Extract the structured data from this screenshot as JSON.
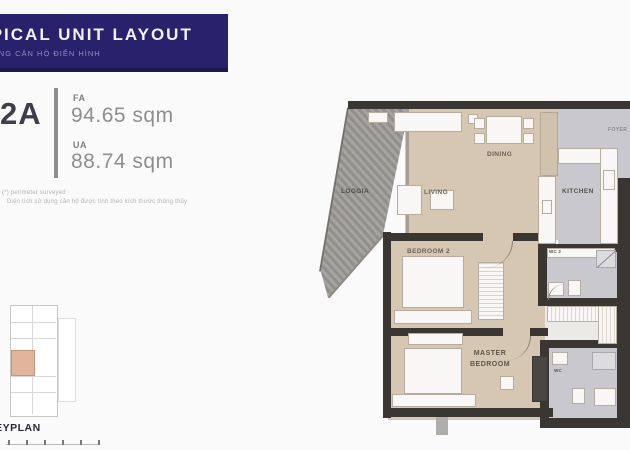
{
  "header": {
    "title": "TYPICAL UNIT LAYOUT",
    "subtitle": "MẶT BẰNG CĂN HỘ ĐIỂN HÌNH"
  },
  "unit": {
    "code": "2A",
    "fa_label": "FA",
    "fa_value": "94.65 sqm",
    "ua_label": "UA",
    "ua_value": "88.74 sqm"
  },
  "notes": {
    "line1": "(*) perimeter surveyed",
    "line2": "Diện tích sử dụng căn hộ được tính theo kích thước thông thủy"
  },
  "keyplan": {
    "label": "KEYPLAN"
  },
  "rooms": {
    "loggia": "LOGGIA",
    "living": "LIVING",
    "dining": "DINING",
    "kitchen": "KITCHEN",
    "foyer": "FOYER",
    "bedroom2": "BEDROOM 2",
    "master1": "MASTER",
    "master2": "BEDROOM",
    "wc2": "WC 2",
    "master_wc": "WC"
  },
  "colors": {
    "navy": "#27226b",
    "floor_tan": "#d5c7b2",
    "floor_gray": "#c8c8ce",
    "wall_dark": "#3a3733",
    "loggia_gray": "#a5a4a0",
    "keyplan_highlight": "#e2b49b"
  }
}
